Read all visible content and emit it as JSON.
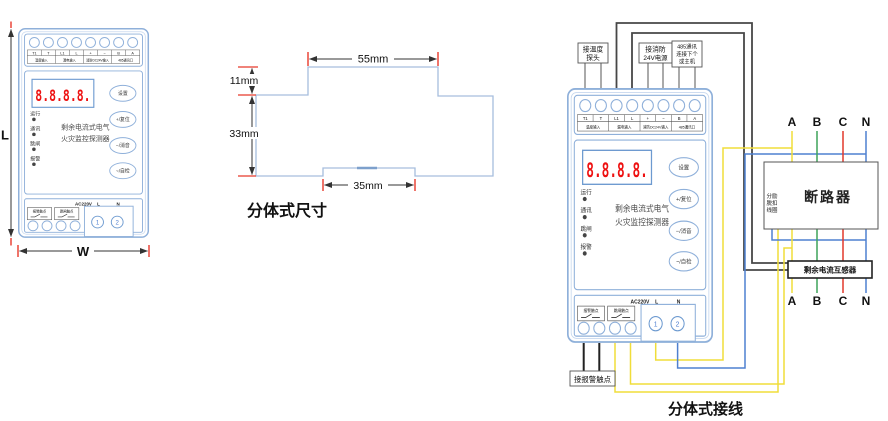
{
  "front_view": {
    "height_label": "L",
    "width_label": "W"
  },
  "device": {
    "display_value": "8.8.8.8.",
    "terminals_top": [
      "T1",
      "T",
      "L1",
      "L",
      "+",
      "−",
      "B",
      "A"
    ],
    "terminal_groups": [
      "温度输入",
      "漏电输入",
      "消防DC24V输入",
      "485通讯口"
    ],
    "leds": [
      "运行",
      "通讯",
      "跳闸",
      "报警"
    ],
    "product_name_line1": "剩余电流式电气",
    "product_name_line2": "火灾监控探测器",
    "buttons": [
      "设置",
      "+/复位",
      "−/消音",
      "~/自检"
    ],
    "power_text": "AC220V",
    "power_l": "L",
    "power_n": "N",
    "output_contacts": [
      "报警触点",
      "跳闸触点"
    ],
    "power_terminal_1": "1",
    "power_terminal_2": "2"
  },
  "profile": {
    "caption": "分体式尺寸",
    "dim_top_width": "55mm",
    "dim_step_height": "11mm",
    "dim_body_height": "33mm",
    "dim_notch_width": "35mm"
  },
  "wiring": {
    "caption": "分体式接线",
    "label_temp_line1": "接温度",
    "label_temp_line2": "探头",
    "label_24v_line1": "接消防",
    "label_24v_line2": "24V电源",
    "label_485_line1": "485通讯",
    "label_485_line2": "连接下个",
    "label_485_line3": "或主机",
    "breaker_label": "断路器",
    "coil_line1": "分励",
    "coil_line2": "脱扣",
    "coil_line3": "线圈",
    "transformer_label": "剩余电流互感器",
    "phases_top": [
      "A",
      "B",
      "C",
      "N"
    ],
    "phases_bottom": [
      "A",
      "B",
      "C",
      "N"
    ],
    "alarm_contact_label": "接报警触点",
    "colors": {
      "phase_a": "#f0dd3a",
      "phase_b": "#3fa45a",
      "phase_c": "#e2382c",
      "phase_n": "#4f80d0",
      "ct_wire": "#474747",
      "display_red": "#ee1111",
      "device_outline": "#8fb0da"
    }
  }
}
